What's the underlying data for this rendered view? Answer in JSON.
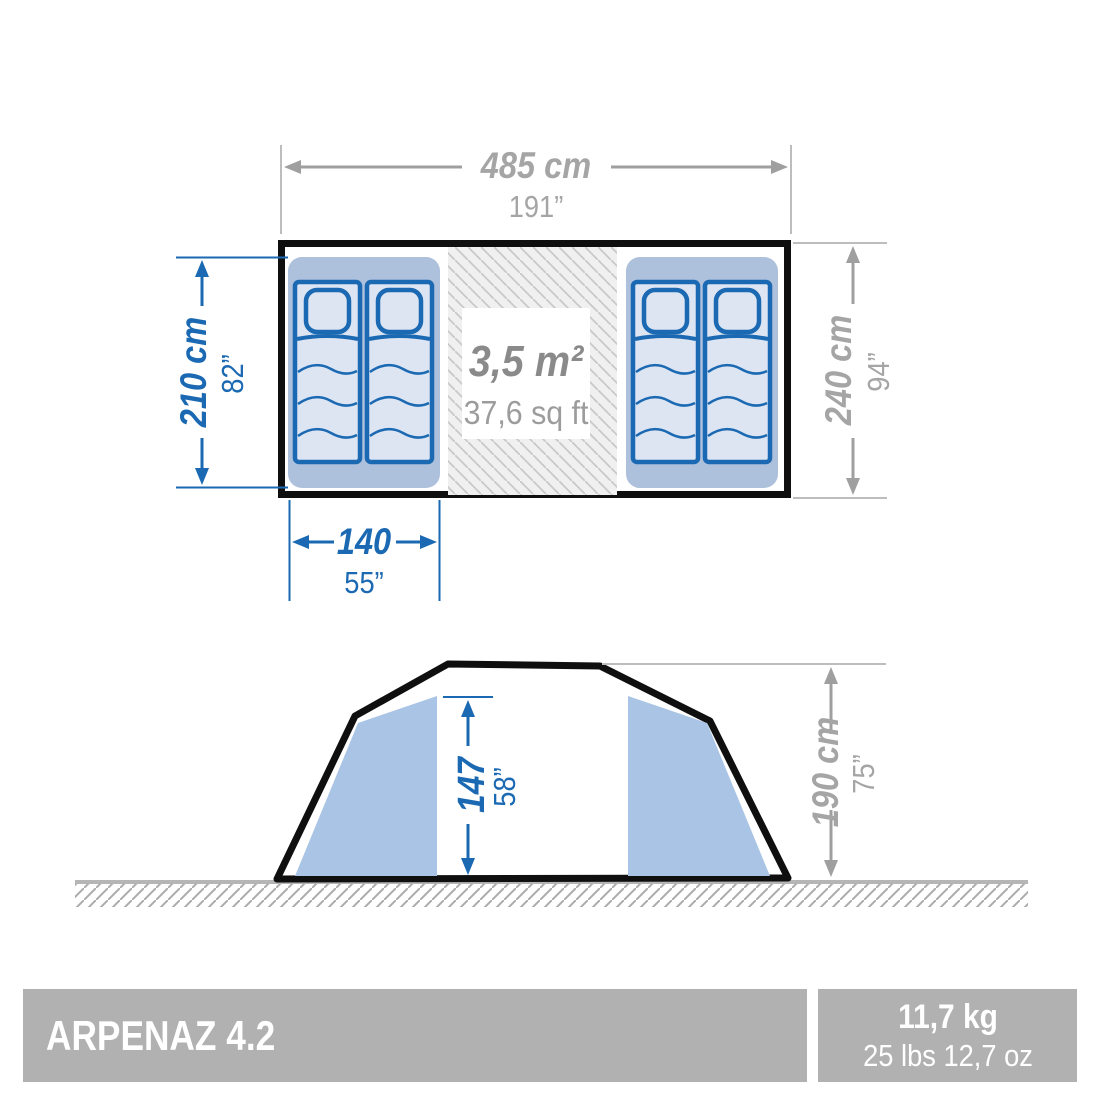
{
  "diagram": {
    "type": "tent-dimension-drawing",
    "views": [
      "top-view-floor-plan",
      "side-view-elevation"
    ]
  },
  "top_view": {
    "width": {
      "metric": "485 cm",
      "imperial": "191”"
    },
    "depth": {
      "metric": "240 cm",
      "imperial": "94”"
    },
    "sleeping_depth": {
      "metric": "210 cm",
      "imperial": "82”"
    },
    "bed_width": {
      "metric": "140",
      "imperial": "55”"
    },
    "living_area": {
      "metric": "3,5 m²",
      "imperial": "37,6 sq ft"
    }
  },
  "side_view": {
    "inner_height": {
      "metric": "147",
      "imperial": "58”"
    },
    "outer_height": {
      "metric": "190 cm",
      "imperial": "75”"
    }
  },
  "footer": {
    "product_name": "ARPENAZ 4.2",
    "weight_metric": "11,7 kg",
    "weight_imperial": "25 lbs 12,7 oz"
  },
  "colors": {
    "interior_dimension_blue": "#1a69b2",
    "exterior_dimension_gray": "#a5a5a5",
    "compartment_blue": "#adc0dc",
    "mattress_fill": "#dde4f2",
    "panel_blue": "#a9c4e4",
    "footer_bar_gray": "#b1b1b1",
    "outline_black": "#0f0f0f"
  }
}
